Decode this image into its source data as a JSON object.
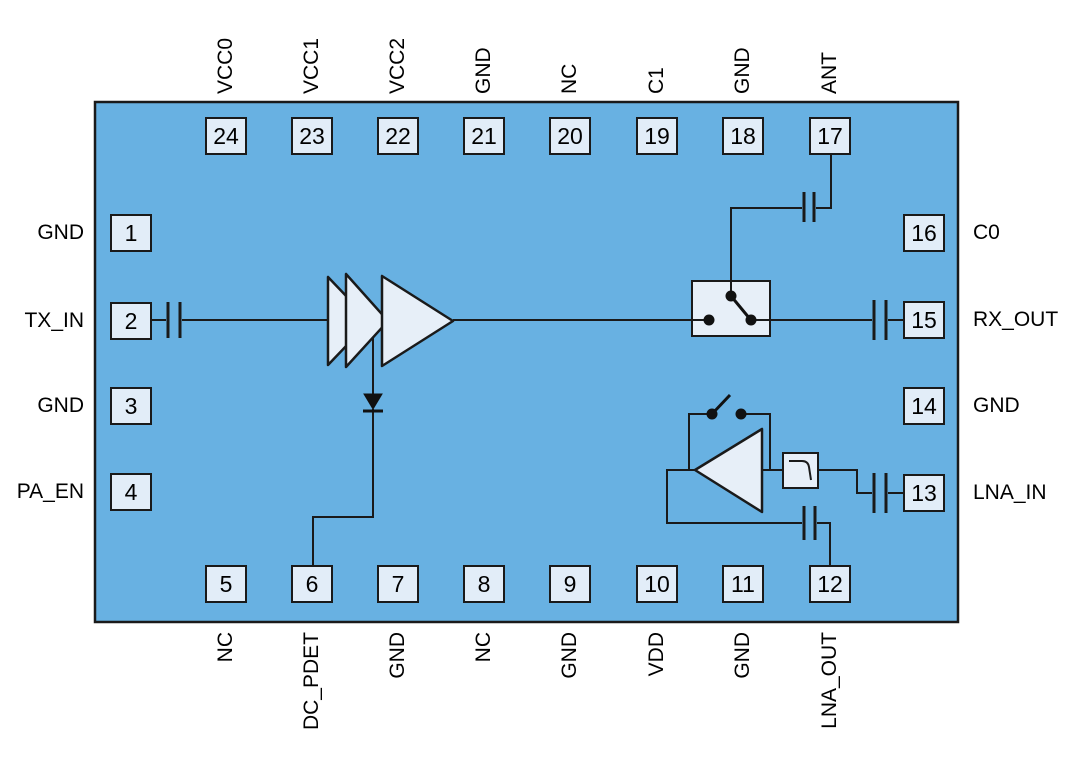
{
  "figure": {
    "type": "ic-functional-block-diagram",
    "colors": {
      "page_background": "#ffffff",
      "chip_fill": "#68b1e2",
      "chip_border": "#1a1a1a",
      "pin_fill": "#e2edf8",
      "block_fill": "#e7eff8",
      "wire": "#1a1a1a",
      "text": "#000000"
    },
    "icons": {
      "pa_chain": "amplifier-chain-3-stage-icon",
      "power_detector": "diode-icon",
      "antenna_switch": "spdt-switch-icon",
      "lna": "amplifier-left-icon",
      "lna_bypass": "open-switch-icon",
      "filter": "filter-response-icon",
      "dc_block": "capacitor-icon"
    }
  },
  "chip": {
    "pins": {
      "top": [
        {
          "number": "24",
          "label": "VCC0"
        },
        {
          "number": "23",
          "label": "VCC1"
        },
        {
          "number": "22",
          "label": "VCC2"
        },
        {
          "number": "21",
          "label": "GND"
        },
        {
          "number": "20",
          "label": "NC"
        },
        {
          "number": "19",
          "label": "C1"
        },
        {
          "number": "18",
          "label": "GND"
        },
        {
          "number": "17",
          "label": "ANT"
        }
      ],
      "bottom": [
        {
          "number": "5",
          "label": "NC"
        },
        {
          "number": "6",
          "label": "DC_PDET"
        },
        {
          "number": "7",
          "label": "GND"
        },
        {
          "number": "8",
          "label": "NC"
        },
        {
          "number": "9",
          "label": "GND"
        },
        {
          "number": "10",
          "label": "VDD"
        },
        {
          "number": "11",
          "label": "GND"
        },
        {
          "number": "12",
          "label": "LNA_OUT"
        }
      ],
      "left": [
        {
          "number": "1",
          "label": "GND"
        },
        {
          "number": "2",
          "label": "TX_IN"
        },
        {
          "number": "3",
          "label": "GND"
        },
        {
          "number": "4",
          "label": "PA_EN"
        }
      ],
      "right": [
        {
          "number": "16",
          "label": "C0"
        },
        {
          "number": "15",
          "label": "RX_OUT"
        },
        {
          "number": "14",
          "label": "GND"
        },
        {
          "number": "13",
          "label": "LNA_IN"
        }
      ]
    }
  }
}
